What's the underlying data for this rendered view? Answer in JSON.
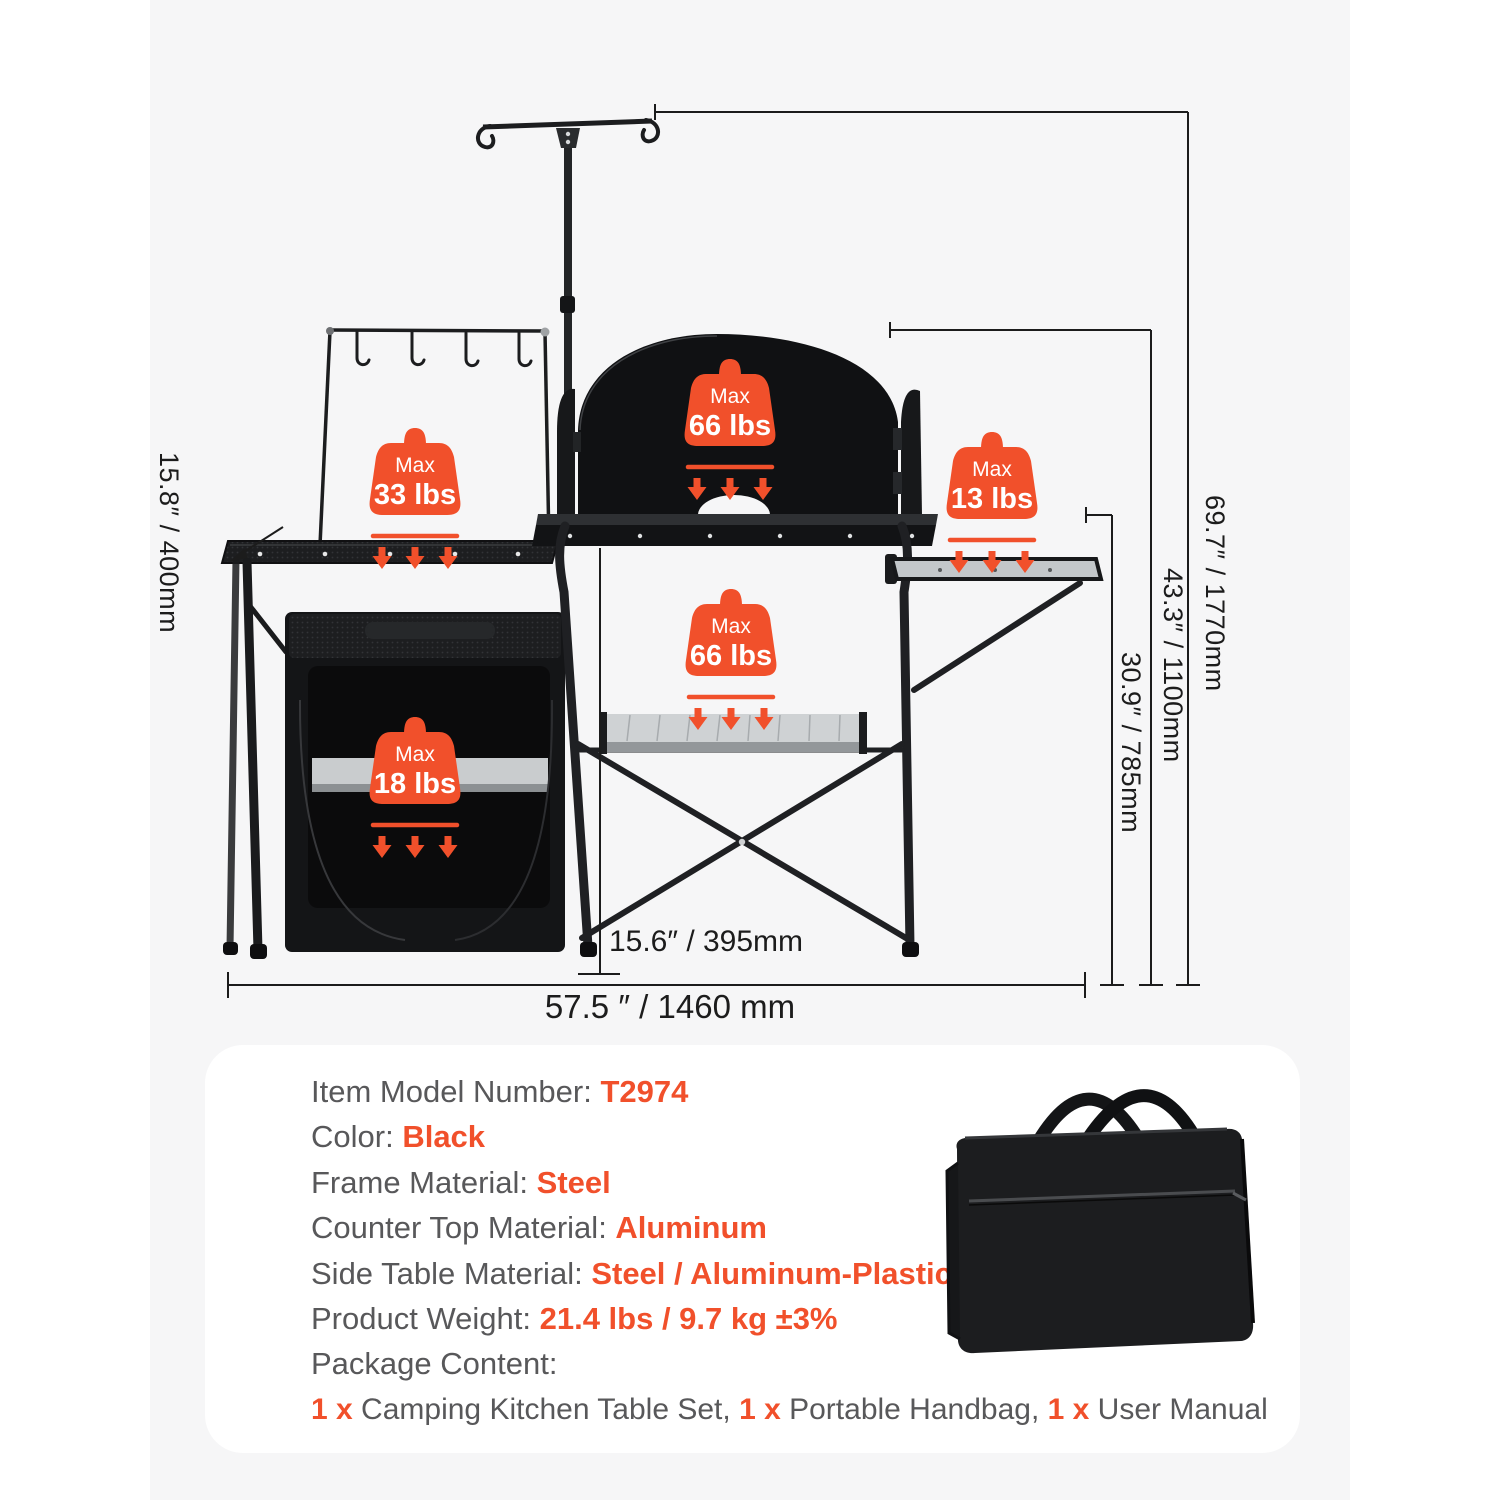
{
  "colors": {
    "accent_orange": "#f1502b",
    "spec_label_gray": "#58585a",
    "panel_background": "#f6f6f7",
    "product_black": "#141517"
  },
  "diagram": {
    "dimensions": {
      "left_table_depth": "15.8″ / 400mm",
      "overall_height": "69.7″ / 1770mm",
      "windscreen_top_height": "43.3″ / 1100mm",
      "tabletop_height": "30.9″ / 785mm",
      "table_depth": "15.6″ / 395mm",
      "overall_width": "57.5 ″ / 1460 mm"
    },
    "badges": [
      {
        "max_label": "Max",
        "value": "33 lbs"
      },
      {
        "max_label": "Max",
        "value": "66 lbs"
      },
      {
        "max_label": "Max",
        "value": "13 lbs"
      },
      {
        "max_label": "Max",
        "value": "66 lbs"
      },
      {
        "max_label": "Max",
        "value": "18 lbs"
      }
    ]
  },
  "specs": {
    "rows": [
      {
        "label": "Item Model Number: ",
        "value": "T2974"
      },
      {
        "label": "Color: ",
        "value": "Black"
      },
      {
        "label": "Frame Material: ",
        "value": "Steel"
      },
      {
        "label": "Counter Top Material: ",
        "value": "Aluminum"
      },
      {
        "label": "Side Table Material: ",
        "value": "Steel / Aluminum-Plastic"
      },
      {
        "label": "Product Weight: ",
        "value": "21.4 lbs / 9.7 kg ±3%"
      },
      {
        "label": "Package Content:",
        "value": ""
      }
    ],
    "package_line": [
      {
        "text": "1 x ",
        "highlight": true
      },
      {
        "text": "Camping Kitchen Table Set, ",
        "highlight": false
      },
      {
        "text": "1 x ",
        "highlight": true
      },
      {
        "text": "Portable Handbag, ",
        "highlight": false
      },
      {
        "text": "1 x ",
        "highlight": true
      },
      {
        "text": "User Manual",
        "highlight": false
      }
    ]
  }
}
